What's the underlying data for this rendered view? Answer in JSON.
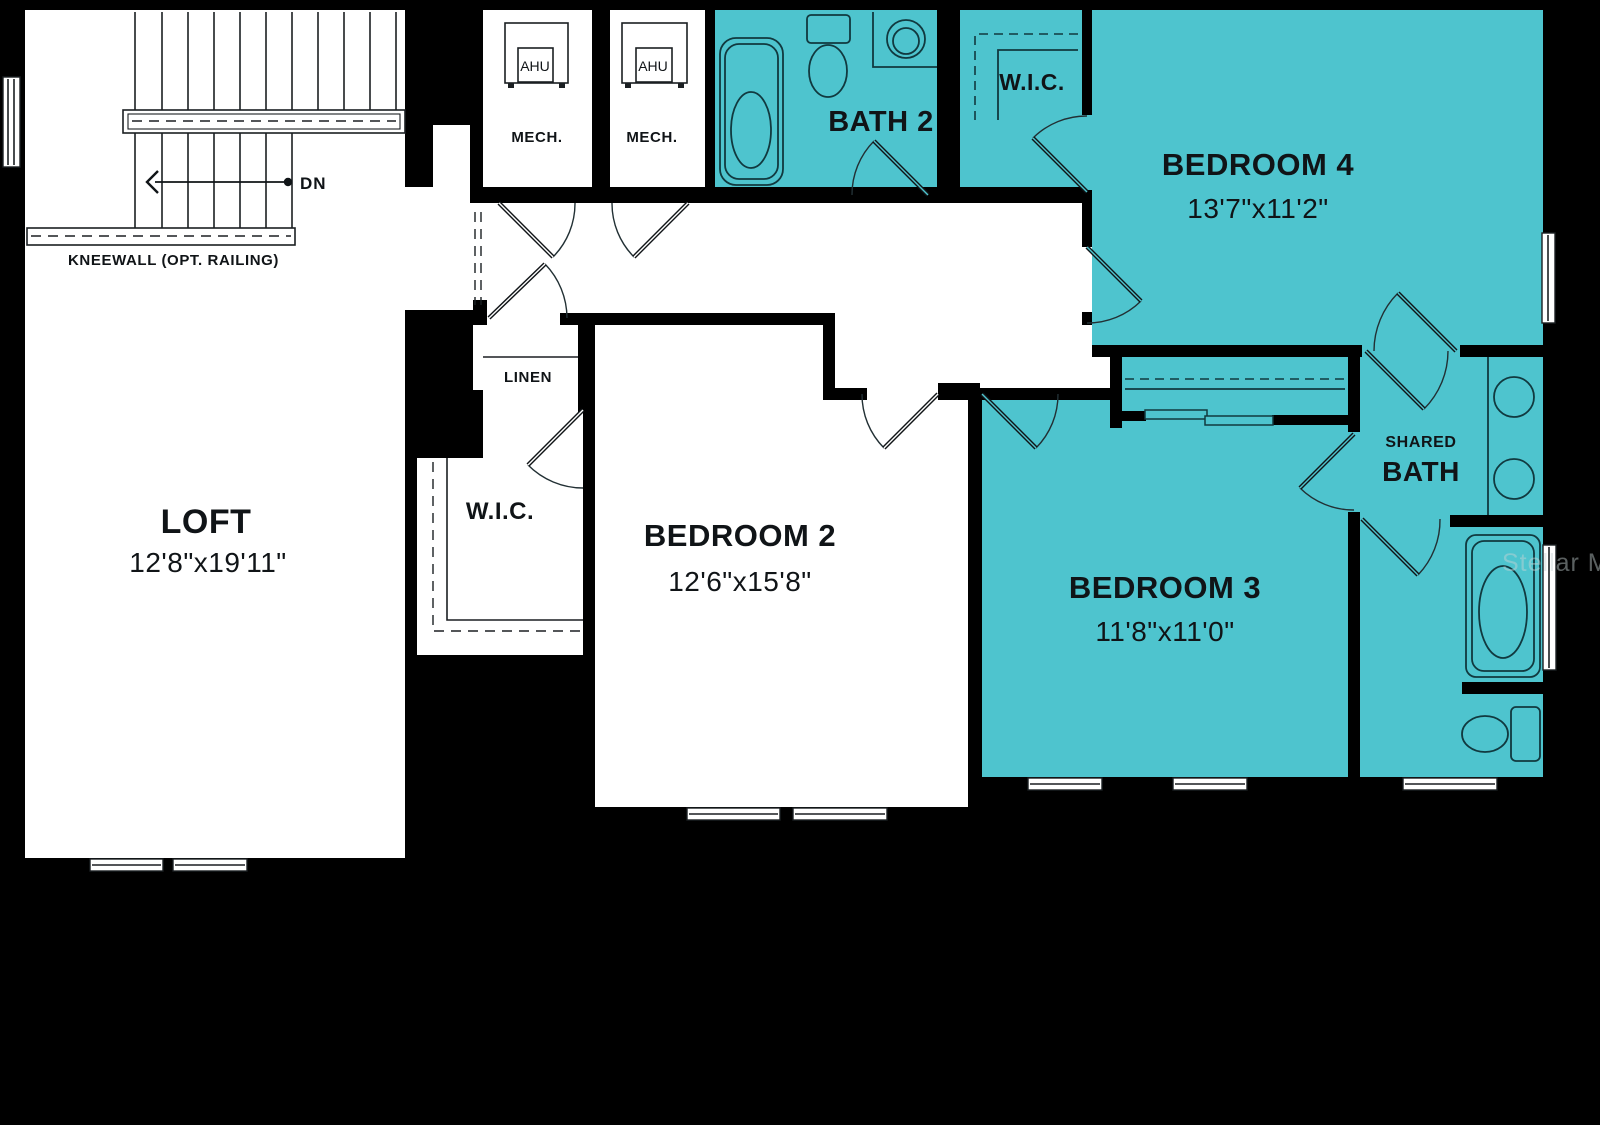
{
  "floorplan": {
    "watermark": "Stellar MLS",
    "rooms": {
      "loft": {
        "name": "LOFT",
        "dims": "12'8\"x19'11\""
      },
      "bedroom2": {
        "name": "BEDROOM 2",
        "dims": "12'6\"x15'8\""
      },
      "bedroom3": {
        "name": "BEDROOM 3",
        "dims": "11'8\"x11'0\""
      },
      "bedroom4": {
        "name": "BEDROOM 4",
        "dims": "13'7\"x11'2\""
      },
      "bath2": {
        "name": "BATH 2"
      },
      "shared_bath": {
        "line1": "SHARED",
        "line2": "BATH"
      },
      "wic_top": {
        "name": "W.I.C."
      },
      "wic_bed2": {
        "name": "W.I.C."
      },
      "linen": {
        "name": "LINEN"
      },
      "mech1": {
        "name": "MECH.",
        "unit": "AHU"
      },
      "mech2": {
        "name": "MECH.",
        "unit": "AHU"
      }
    },
    "stairs": {
      "down_label": "DN",
      "kneewall_label": "KNEEWALL (OPT. RAILING)"
    },
    "colors": {
      "highlight_teal": "#4EC4CE",
      "background": "#000000",
      "room_fill": "#FFFFFF",
      "line": "#101417"
    }
  }
}
